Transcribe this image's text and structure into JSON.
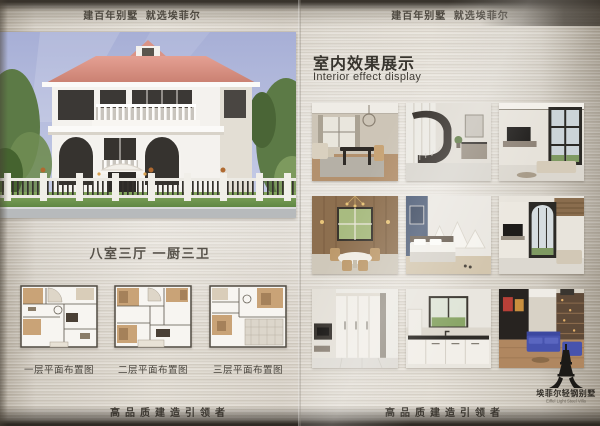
{
  "headers": {
    "left": "建百年别墅  就选埃菲尔",
    "right": "建百年别墅  就选埃菲尔"
  },
  "footers": {
    "left": "高品质建造引领者",
    "right": "高品质建造引领者"
  },
  "left_page": {
    "caption": "八室三厅 一厨三卫",
    "floor_plans": [
      {
        "label": "一层平面布置图"
      },
      {
        "label": "二层平面布置图"
      },
      {
        "label": "三层平面布置图"
      }
    ]
  },
  "right_page": {
    "title_cn": "室内效果展示",
    "title_en": "Interior effect display",
    "photos": [
      {
        "name": "living-dining-room"
      },
      {
        "name": "staircase-hall"
      },
      {
        "name": "double-height-living-room"
      },
      {
        "name": "wood-panel-dining-room"
      },
      {
        "name": "bedroom-blue-accent"
      },
      {
        "name": "tall-window-living-room"
      },
      {
        "name": "wardrobe-hallway"
      },
      {
        "name": "kitchen"
      },
      {
        "name": "home-theater-blue-sofas"
      }
    ]
  },
  "logo": {
    "icon": "eiffel-tower-icon",
    "name_cn": "埃菲尔轻钢别墅",
    "name_en": "Eiffel Light Steel Villa"
  },
  "colors": {
    "metal_light": "#e3ded5",
    "metal_dark": "#55504a",
    "text_dark": "#46423b",
    "roof_pink": "#d98e80",
    "sky_blue": "#aab2d9",
    "plan_tan": "#c9a377",
    "sofa_blue": "#4753ae"
  }
}
